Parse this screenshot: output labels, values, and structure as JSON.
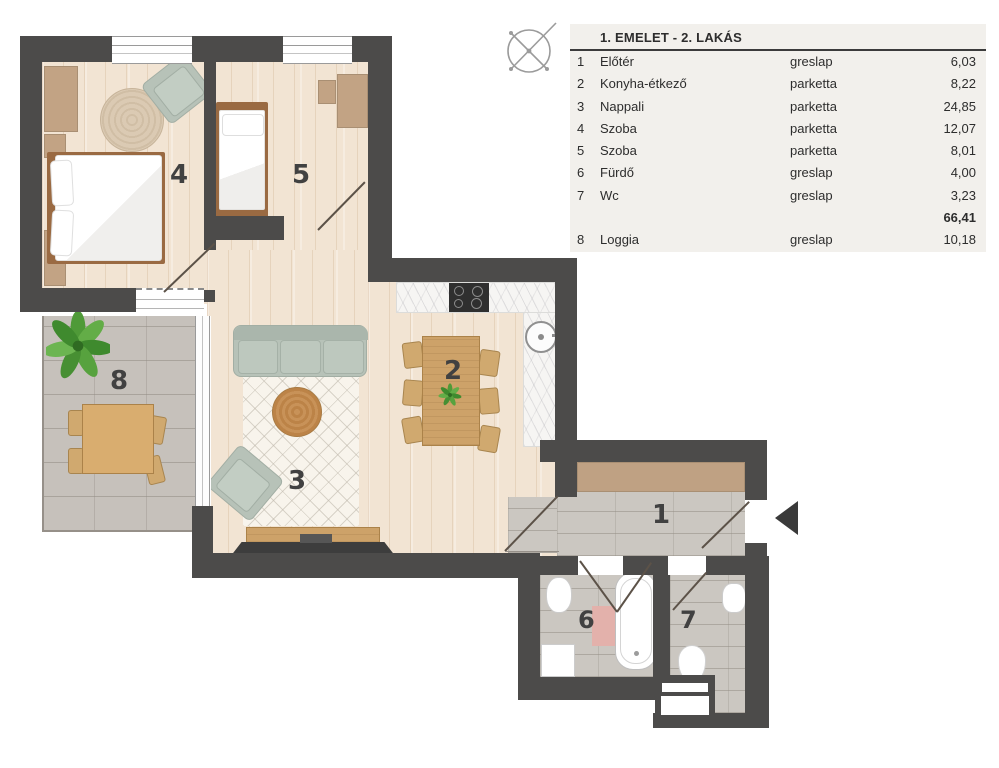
{
  "table": {
    "title": "1. EMELET - 2. LAKÁS",
    "rows": [
      {
        "num": "1",
        "name": "Előtér",
        "material": "greslap",
        "area": "6,03"
      },
      {
        "num": "2",
        "name": "Konyha-étkező",
        "material": "parketta",
        "area": "8,22"
      },
      {
        "num": "3",
        "name": "Nappali",
        "material": "parketta",
        "area": "24,85"
      },
      {
        "num": "4",
        "name": "Szoba",
        "material": "parketta",
        "area": "12,07"
      },
      {
        "num": "5",
        "name": "Szoba",
        "material": "parketta",
        "area": "8,01"
      },
      {
        "num": "6",
        "name": "Fürdő",
        "material": "greslap",
        "area": "4,00"
      },
      {
        "num": "7",
        "name": "Wc",
        "material": "greslap",
        "area": "3,23"
      },
      {
        "num": "",
        "name": "",
        "material": "",
        "area": "66,41"
      },
      {
        "num": "8",
        "name": "Loggia",
        "material": "greslap",
        "area": "10,18"
      }
    ]
  },
  "plan": {
    "room_labels": [
      "1",
      "2",
      "3",
      "4",
      "5",
      "6",
      "7",
      "8"
    ]
  },
  "colors": {
    "wall": "#4c4b4a",
    "wood_floor": "#f2e4d3",
    "tile_floor": "#cbc7c1",
    "counter": "#f6f5f3",
    "furniture_wood": "#c9a167",
    "sofa": "#b7c2b8",
    "label": "#414141",
    "table_bg": "#f2f0ec"
  }
}
